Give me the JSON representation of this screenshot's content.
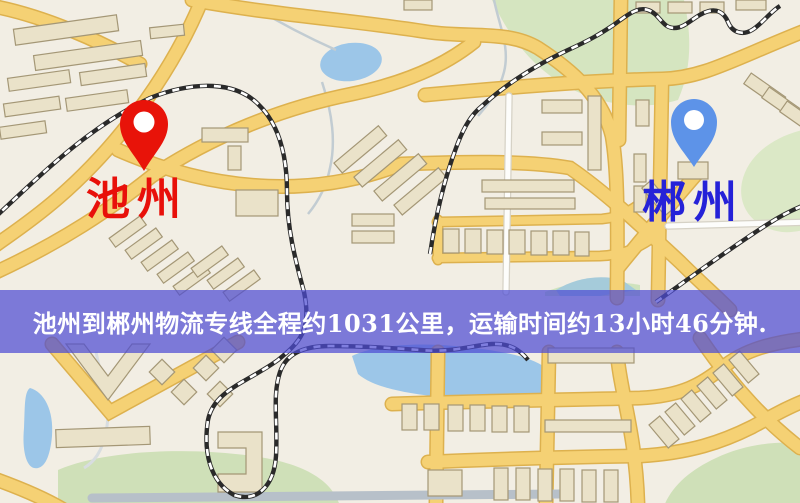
{
  "map": {
    "origin_marker": {
      "name": "池州",
      "pin_color": "#e81309",
      "label_color": "#e8100a"
    },
    "destination_marker": {
      "name": "郴州",
      "pin_color": "#5d93e8",
      "label_color": "#2522d8"
    }
  },
  "banner": {
    "text": "池州到郴州物流专线全程约1031公里，运输时间约13小时46分钟.",
    "background_color": "rgba(77,76,211,0.72)",
    "text_color": "#ffffff",
    "route": {
      "origin": "池州",
      "destination": "郴州",
      "service": "物流专线",
      "distance": "约1031公里",
      "duration": "约13小时46分钟"
    }
  },
  "palette": {
    "map_background": "#f2eee4",
    "road_major_fill": "#f5d174",
    "road_major_casing": "#ddb14e",
    "road_minor_fill": "#fdfdfb",
    "road_grey": "#b7c0c9",
    "railway": "#2a2a2a",
    "water": "#9cc6e8",
    "park_green": "#d5e5c0",
    "building_fill": "#eae2c9",
    "building_stroke": "#a49776"
  }
}
